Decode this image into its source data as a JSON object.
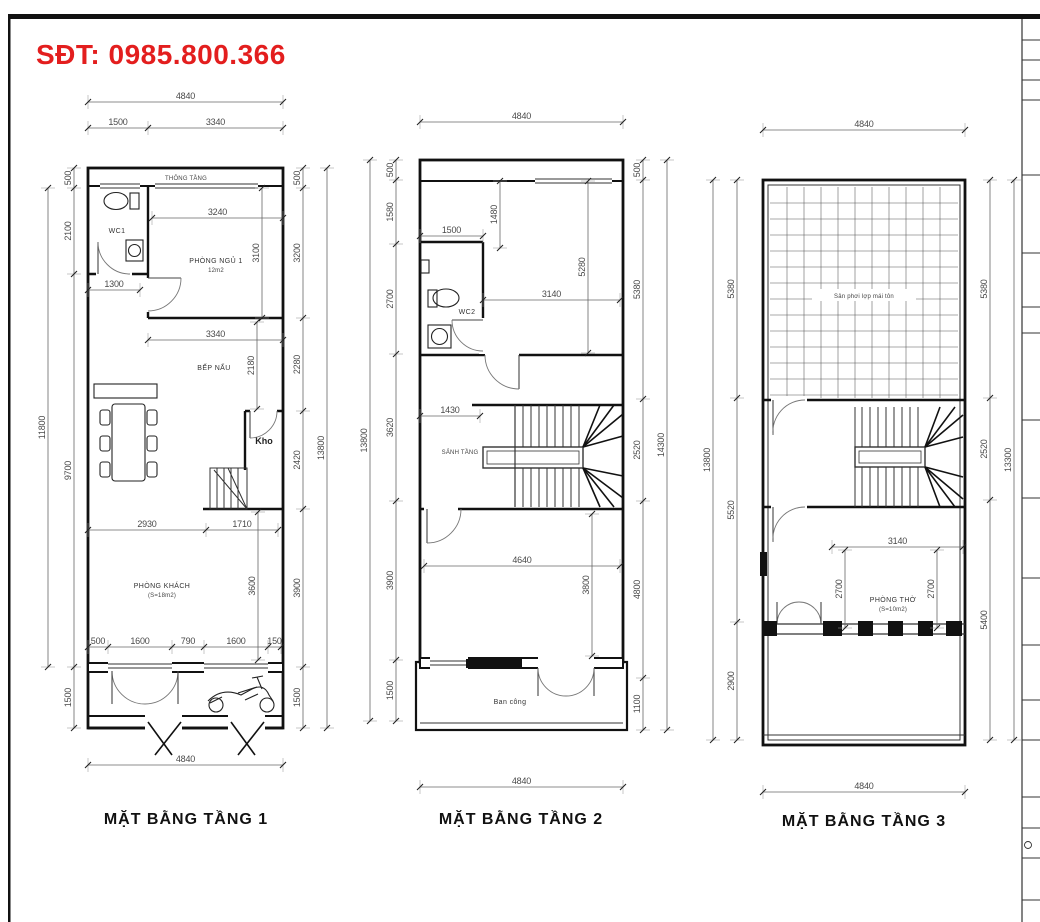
{
  "sheet": {
    "phone_label": "SĐT: 0985.800.366",
    "accent_red": "#e31e1e",
    "line_color": "#111111"
  },
  "plans": [
    {
      "caption": "MẶT BẰNG TẦNG 1",
      "rooms": {
        "void": "THÔNG TẦNG",
        "wc": "WC1",
        "bedroom": "PHÒNG NGỦ 1",
        "bedroom_area": "12m2",
        "kitchen": "BẾP NẤU",
        "storage": "Kho",
        "living": "PHÒNG KHÁCH",
        "living_area": "(S=18m2)"
      },
      "chains": [
        {
          "axis": "h",
          "pos": 102,
          "ticks": [
            88,
            283
          ],
          "labels": [
            "4840"
          ]
        },
        {
          "axis": "h",
          "pos": 128,
          "ticks": [
            88,
            148,
            283
          ],
          "labels": [
            "1500",
            "3340"
          ]
        },
        {
          "axis": "h",
          "pos": 218,
          "ticks": [
            152,
            283
          ],
          "labels": [
            "3240"
          ]
        },
        {
          "axis": "h",
          "pos": 290,
          "ticks": [
            88,
            140
          ],
          "labels": [
            "1300"
          ]
        },
        {
          "axis": "h",
          "pos": 340,
          "ticks": [
            148,
            283
          ],
          "labels": [
            "3340"
          ]
        },
        {
          "axis": "h",
          "pos": 530,
          "ticks": [
            88,
            206,
            278
          ],
          "labels": [
            "2930",
            "1710"
          ]
        },
        {
          "axis": "h",
          "pos": 647,
          "ticks": [
            88,
            108,
            172,
            204,
            268,
            281
          ],
          "labels": [
            "500",
            "1600",
            "790",
            "1600",
            "150"
          ]
        },
        {
          "axis": "h",
          "pos": 765,
          "ticks": [
            88,
            283
          ],
          "labels": [
            "4840"
          ]
        },
        {
          "axis": "v",
          "pos": 48,
          "ticks": [
            188,
            667
          ],
          "labels": [
            "11800"
          ]
        },
        {
          "axis": "v",
          "pos": 74,
          "ticks": [
            168,
            188,
            274,
            667,
            728
          ],
          "labels": [
            "500",
            "2100",
            "9700",
            "1500"
          ]
        },
        {
          "axis": "v",
          "pos": 262,
          "ticks": [
            188,
            318
          ],
          "labels": [
            "3100"
          ]
        },
        {
          "axis": "v",
          "pos": 257,
          "ticks": [
            322,
            409
          ],
          "labels": [
            "2180"
          ]
        },
        {
          "axis": "v",
          "pos": 258,
          "ticks": [
            512,
            660
          ],
          "labels": [
            "3600"
          ]
        },
        {
          "axis": "v",
          "pos": 303,
          "ticks": [
            168,
            188,
            318,
            411,
            509,
            667,
            728
          ],
          "labels": [
            "500",
            "3200",
            "2280",
            "2420",
            "3900",
            "1500"
          ]
        },
        {
          "axis": "v",
          "pos": 327,
          "ticks": [
            168,
            728
          ],
          "labels": [
            "13800"
          ]
        }
      ]
    },
    {
      "caption": "MẶT BẰNG TẦNG 2",
      "rooms": {
        "wc": "WC2",
        "hall": "SẢNH TẦNG",
        "balcony": "Ban công"
      },
      "chains": [
        {
          "axis": "h",
          "pos": 122,
          "ticks": [
            420,
            623
          ],
          "labels": [
            "4840"
          ]
        },
        {
          "axis": "h",
          "pos": 236,
          "ticks": [
            420,
            483
          ],
          "labels": [
            "1500"
          ]
        },
        {
          "axis": "h",
          "pos": 300,
          "ticks": [
            483,
            620
          ],
          "labels": [
            "3140"
          ]
        },
        {
          "axis": "h",
          "pos": 416,
          "ticks": [
            420,
            480
          ],
          "labels": [
            "1430"
          ]
        },
        {
          "axis": "h",
          "pos": 566,
          "ticks": [
            424,
            620
          ],
          "labels": [
            "4640"
          ]
        },
        {
          "axis": "h",
          "pos": 787,
          "ticks": [
            420,
            623
          ],
          "labels": [
            "4840"
          ]
        },
        {
          "axis": "v",
          "pos": 370,
          "ticks": [
            160,
            721
          ],
          "labels": [
            "13800"
          ]
        },
        {
          "axis": "v",
          "pos": 396,
          "ticks": [
            160,
            180,
            244,
            354,
            501,
            660,
            721
          ],
          "labels": [
            "500",
            "1580",
            "2700",
            "3620",
            "3900",
            "1500"
          ]
        },
        {
          "axis": "v",
          "pos": 500,
          "ticks": [
            181,
            248
          ],
          "labels": [
            "1480"
          ]
        },
        {
          "axis": "v",
          "pos": 588,
          "ticks": [
            181,
            353
          ],
          "labels": [
            "5280"
          ]
        },
        {
          "axis": "v",
          "pos": 592,
          "ticks": [
            514,
            656
          ],
          "labels": [
            "3800"
          ]
        },
        {
          "axis": "v",
          "pos": 643,
          "ticks": [
            160,
            180,
            399,
            501,
            678,
            730
          ],
          "labels": [
            "500",
            "5380",
            "2520",
            "4800",
            "1100"
          ]
        },
        {
          "axis": "v",
          "pos": 667,
          "ticks": [
            160,
            730
          ],
          "labels": [
            "14300"
          ]
        }
      ]
    },
    {
      "caption": "MẶT BẰNG TẦNG 3",
      "rooms": {
        "roof": "Sân phơi lợp mái tôn",
        "worship": "PHÒNG THỜ",
        "worship_area": "(S=10m2)"
      },
      "chains": [
        {
          "axis": "h",
          "pos": 130,
          "ticks": [
            763,
            965
          ],
          "labels": [
            "4840"
          ]
        },
        {
          "axis": "h",
          "pos": 547,
          "ticks": [
            832,
            963
          ],
          "labels": [
            "3140"
          ]
        },
        {
          "axis": "h",
          "pos": 792,
          "ticks": [
            763,
            965
          ],
          "labels": [
            "4840"
          ]
        },
        {
          "axis": "v",
          "pos": 713,
          "ticks": [
            180,
            740
          ],
          "labels": [
            "13800"
          ]
        },
        {
          "axis": "v",
          "pos": 737,
          "ticks": [
            180,
            398,
            622,
            740
          ],
          "labels": [
            "5380",
            "5520",
            "2900"
          ]
        },
        {
          "axis": "v",
          "pos": 845,
          "ticks": [
            550,
            628
          ],
          "labels": [
            "2700"
          ]
        },
        {
          "axis": "v",
          "pos": 937,
          "ticks": [
            550,
            628
          ],
          "labels": [
            "2700"
          ]
        },
        {
          "axis": "v",
          "pos": 990,
          "ticks": [
            180,
            398,
            500,
            740
          ],
          "labels": [
            "5380",
            "2520",
            "5400"
          ]
        },
        {
          "axis": "v",
          "pos": 1014,
          "ticks": [
            180,
            740
          ],
          "labels": [
            "13300"
          ]
        }
      ]
    }
  ]
}
